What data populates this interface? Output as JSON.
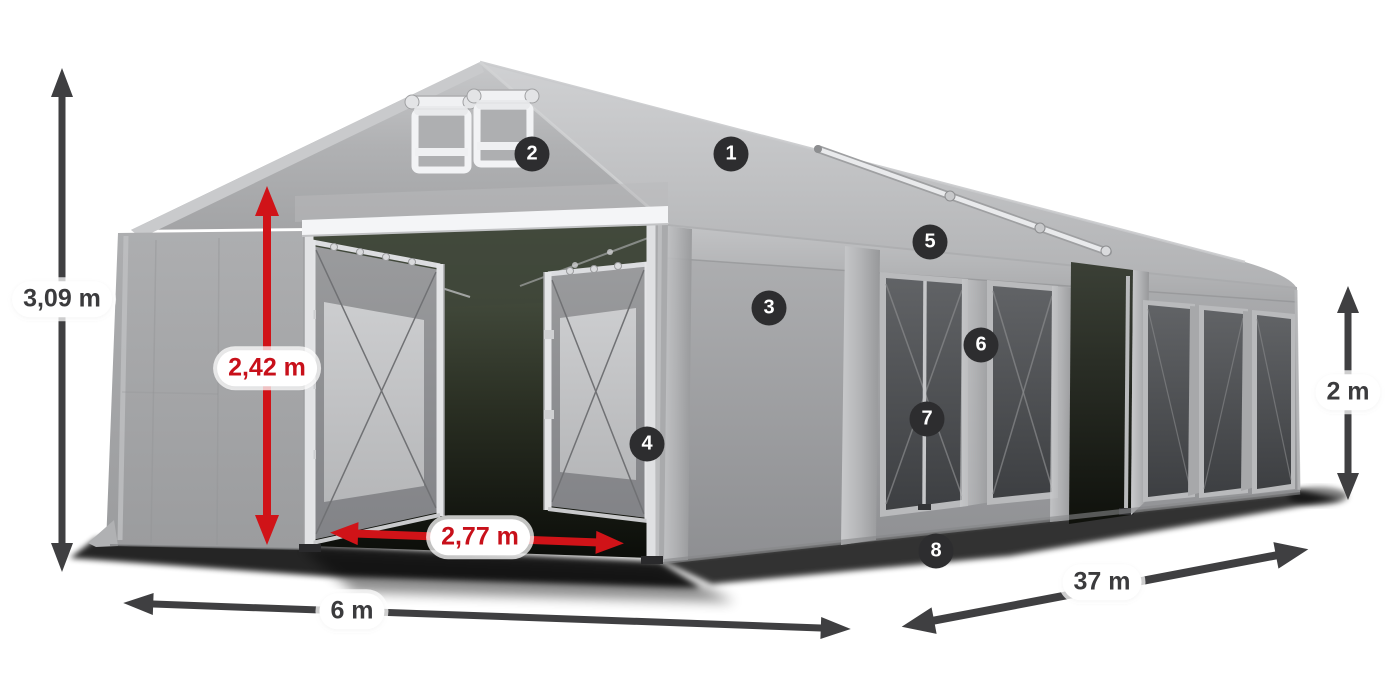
{
  "view": {
    "type": "product-dimension-diagram",
    "background": "#ffffff"
  },
  "palette": {
    "arrow_dark": "#3f3f41",
    "arrow_red": "#d01318",
    "label_text_dark": "#3b3b3d",
    "label_text_red": "#c8101a",
    "label_pill_bg": "#ffffff",
    "callout_bg": "#2d2d2f",
    "callout_text": "#ffffff",
    "tent_fabric": "#a6a7a9",
    "tent_roof": "#c3c4c6",
    "window_tint": "#4b4d50",
    "frame_metal": "#e2e3e5"
  },
  "dimensions": [
    {
      "id": "total-height",
      "label": "3,09 m",
      "style": "dark"
    },
    {
      "id": "entrance-height",
      "label": "2,42 m",
      "style": "red"
    },
    {
      "id": "entrance-width",
      "label": "2,77 m",
      "style": "red"
    },
    {
      "id": "tent-width",
      "label": "6 m",
      "style": "dark"
    },
    {
      "id": "tent-length",
      "label": "37 m",
      "style": "dark"
    },
    {
      "id": "side-height",
      "label": "2 m",
      "style": "dark"
    }
  ],
  "callouts": [
    {
      "number": "1"
    },
    {
      "number": "2"
    },
    {
      "number": "3"
    },
    {
      "number": "4"
    },
    {
      "number": "5"
    },
    {
      "number": "6"
    },
    {
      "number": "7"
    },
    {
      "number": "8"
    }
  ]
}
